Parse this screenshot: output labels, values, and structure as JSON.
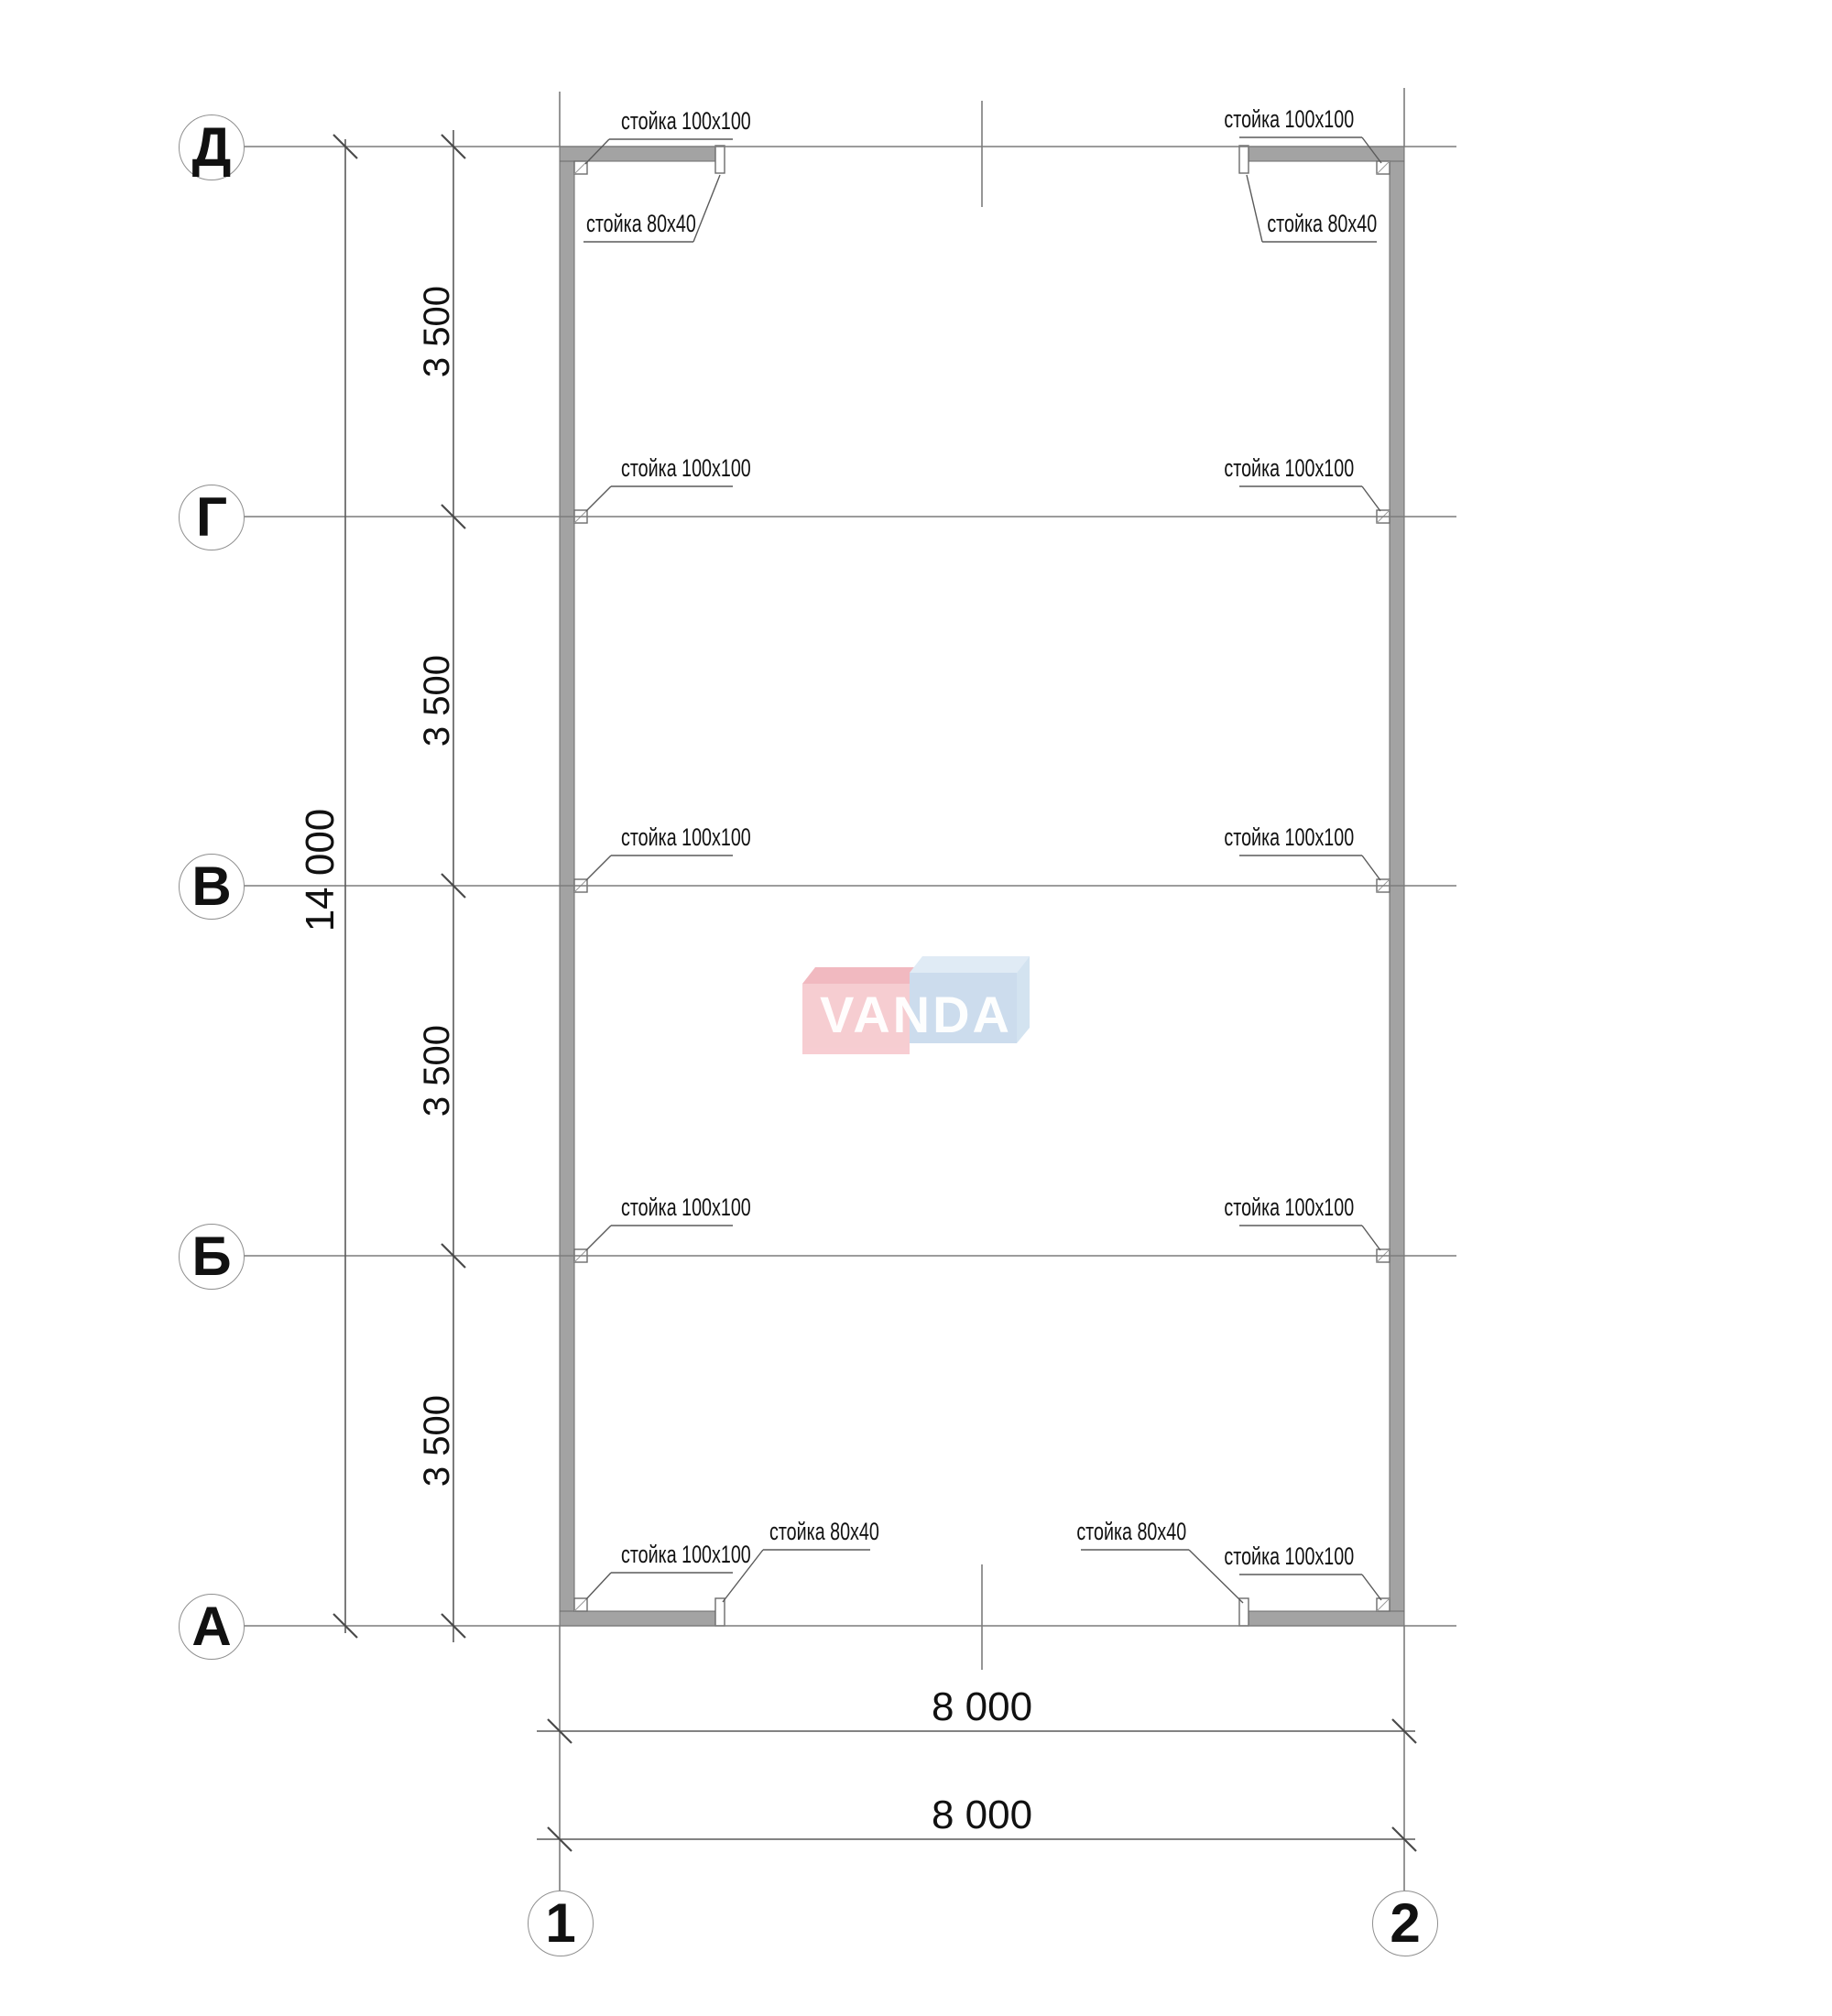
{
  "drawing": {
    "kind": "frame plan (план каркаса)",
    "axes": {
      "rows": [
        {
          "label": "Д"
        },
        {
          "label": "Г"
        },
        {
          "label": "В"
        },
        {
          "label": "Б"
        },
        {
          "label": "А"
        }
      ],
      "cols": [
        {
          "label": "1"
        },
        {
          "label": "2"
        }
      ]
    },
    "dimensions": {
      "overall_height": "14 000",
      "bay_spacing": "3 500",
      "overall_width": "8 000"
    },
    "annotations": {
      "post_100x100": "стойка 100x100",
      "post_80x40": "стойка 80x40"
    }
  },
  "watermark": {
    "text": "VANDA",
    "colors": {
      "pink_front": "#f6c8cd",
      "pink_top": "#f0b2ba",
      "blue_front": "#c7d9ec",
      "blue_top": "#dde9f5",
      "blue_side": "#cfe0ef",
      "letters": "#ffffff"
    }
  },
  "palette": {
    "wall_fill": "#a3a3a3",
    "wall_stroke": "#6b6b6b",
    "grid_line": "#7c7c7c",
    "dim_line": "#5a5a5a",
    "text": "#111111"
  }
}
